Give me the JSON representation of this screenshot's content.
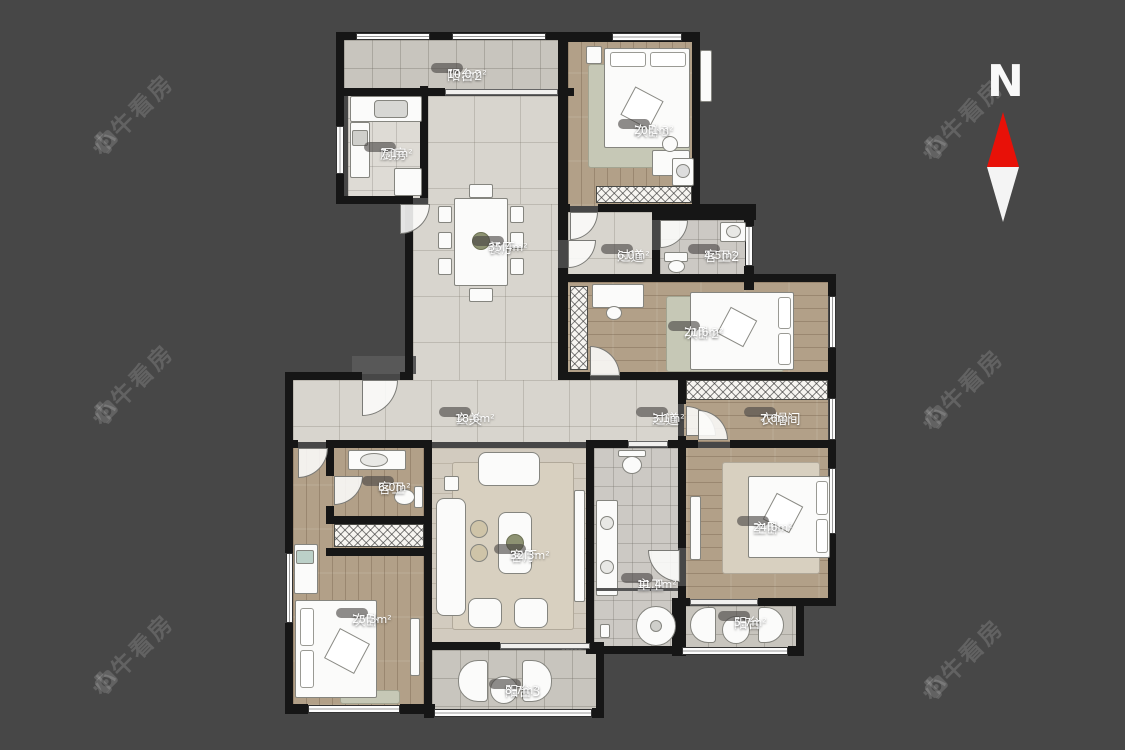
{
  "watermark": {
    "text": "小牛看房"
  },
  "compass": {
    "label": "N"
  },
  "rooms": [
    {
      "name": "阳台2",
      "area": "10.0m²"
    },
    {
      "name": "厨房",
      "area": "7.1m²"
    },
    {
      "name": "次卧3",
      "area": "20.1m²"
    },
    {
      "name": "餐厅",
      "area": "35.4m²"
    },
    {
      "name": "过道",
      "area": "6.0m²"
    },
    {
      "name": "客卫2",
      "area": "4.5m²"
    },
    {
      "name": "次卧2",
      "area": "21.6m²"
    },
    {
      "name": "玄关",
      "area": "18.6m²"
    },
    {
      "name": "过道",
      "area": "3.1m²"
    },
    {
      "name": "衣帽间",
      "area": "7.6m²"
    },
    {
      "name": "客卫",
      "area": "6.0m²"
    },
    {
      "name": "客厅",
      "area": "32.3m²"
    },
    {
      "name": "主卫",
      "area": "11.4m²"
    },
    {
      "name": "主卧",
      "area": "24.6m²"
    },
    {
      "name": "次卧",
      "area": "25.3m²"
    },
    {
      "name": "阳台",
      "area": "5.7m²"
    },
    {
      "name": "阳台3",
      "area": "8.7m²"
    }
  ]
}
